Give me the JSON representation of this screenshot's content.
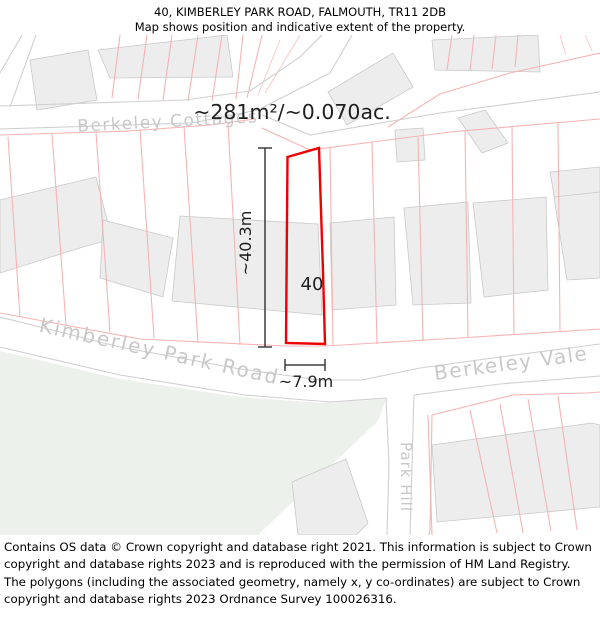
{
  "header": {
    "title": "40, KIMBERLEY PARK ROAD, FALMOUTH, TR11 2DB",
    "subtitle": "Map shows position and indicative extent of the property."
  },
  "map": {
    "area_label": "~281m²/~0.070ac.",
    "plot_number": "40",
    "measurements": {
      "height": "~40.3m",
      "width": "~7.9m"
    },
    "road_labels": {
      "berkeley_cottages": "Berkeley Cottages",
      "kimberley_park_road": "Kimberley Park Road",
      "berkeley_vale": "Berkeley Vale",
      "park_hill": "Park Hill"
    }
  },
  "footer": {
    "attribution": "Contains OS data © Crown copyright and database right 2021. This information is subject to Crown copyright and database rights 2023 and is reproduced with the permission of HM Land Registry. The polygons (including the associated geometry, namely x, y co-ordinates) are subject to Crown copyright and database rights 2023 Ordnance Survey 100026316."
  },
  "colors": {
    "plot_outline": "#ed0000",
    "parcel_line": "#f5b4b4",
    "building_fill": "#ededed",
    "building_stroke": "#c9c9c9",
    "road_edge": "#cfcfcf",
    "road_label": "#c8c8c8",
    "green_space": "#edf1eb",
    "measurement": "#3d3d3d"
  }
}
